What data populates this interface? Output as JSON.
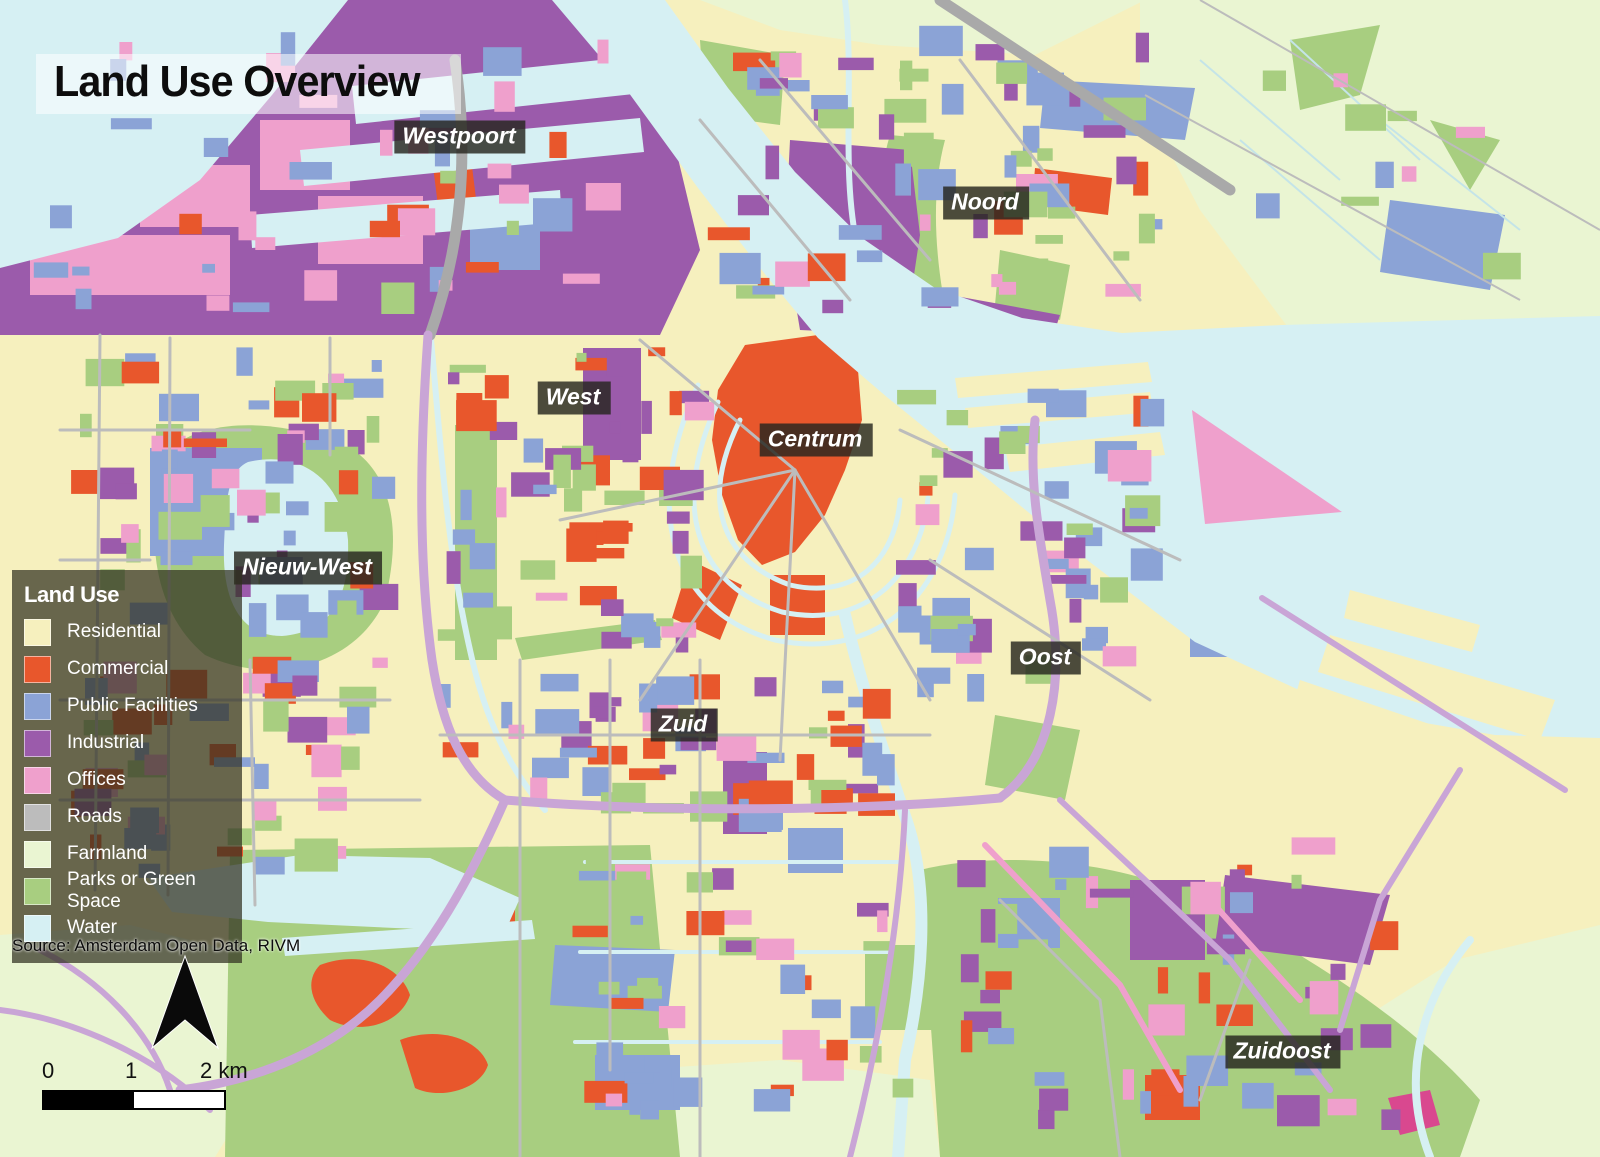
{
  "title": "Land Use Overview",
  "legend": {
    "title": "Land Use",
    "items": [
      {
        "key": "residential",
        "label": "Residential",
        "color": "#f6f0be"
      },
      {
        "key": "commercial",
        "label": "Commercial",
        "color": "#e8572c"
      },
      {
        "key": "public",
        "label": "Public Facilities",
        "color": "#8ba3d6"
      },
      {
        "key": "industrial",
        "label": "Industrial",
        "color": "#9b5bab"
      },
      {
        "key": "offices",
        "label": "Offices",
        "color": "#efa0cc"
      },
      {
        "key": "roads",
        "label": "Roads",
        "color": "#bcbcbc"
      },
      {
        "key": "farmland",
        "label": "Farmland",
        "color": "#eaf5d2"
      },
      {
        "key": "parks",
        "label": "Parks or Green Space",
        "color": "#a8ce80"
      },
      {
        "key": "water",
        "label": "Water",
        "color": "#d6f0f3"
      }
    ]
  },
  "districts": [
    {
      "name": "Westpoort"
    },
    {
      "name": "Noord"
    },
    {
      "name": "West"
    },
    {
      "name": "Centrum"
    },
    {
      "name": "Nieuw-West"
    },
    {
      "name": "Oost"
    },
    {
      "name": "Zuid"
    },
    {
      "name": "Zuidoost"
    }
  ],
  "source": "Source: Amsterdam Open Data, RIVM",
  "scale_bar": {
    "start": "0",
    "mid": "1",
    "end": "2 km"
  },
  "map_colors": {
    "highway": "#c9a5d6",
    "road_major": "#a9a9a9",
    "accent_magenta": "#d9488f"
  }
}
